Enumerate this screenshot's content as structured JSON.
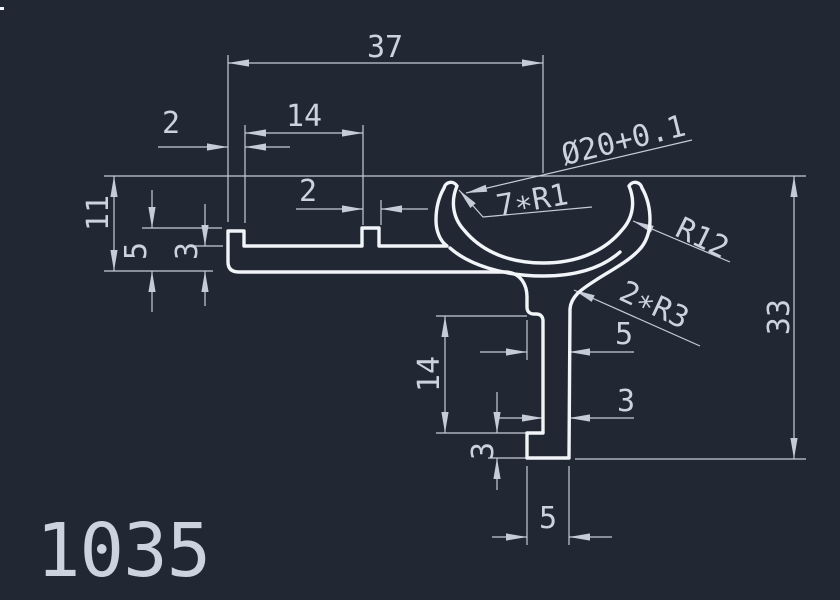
{
  "colors": {
    "background": "#212833",
    "profile-line": "#f1f4f8",
    "dimension-line": "#c5ccd8",
    "text": "#ccd3df"
  },
  "drawing": {
    "part_number": "1035",
    "labels": {
      "width_overall": "37",
      "slot_offset": "14",
      "lip_width": "2",
      "tab_width": "2",
      "diameter": "Ø20+0.1",
      "tip_radius": "7∗R1",
      "outer_radius": "R12",
      "fillet_radius": "2∗R3",
      "height_left": "11",
      "lip_height": "5",
      "wall_left": "3",
      "stem_length": "14",
      "stem_width": "5",
      "leg_width": "3",
      "foot_height": "3",
      "foot_width": "5",
      "height_right": "33"
    }
  }
}
